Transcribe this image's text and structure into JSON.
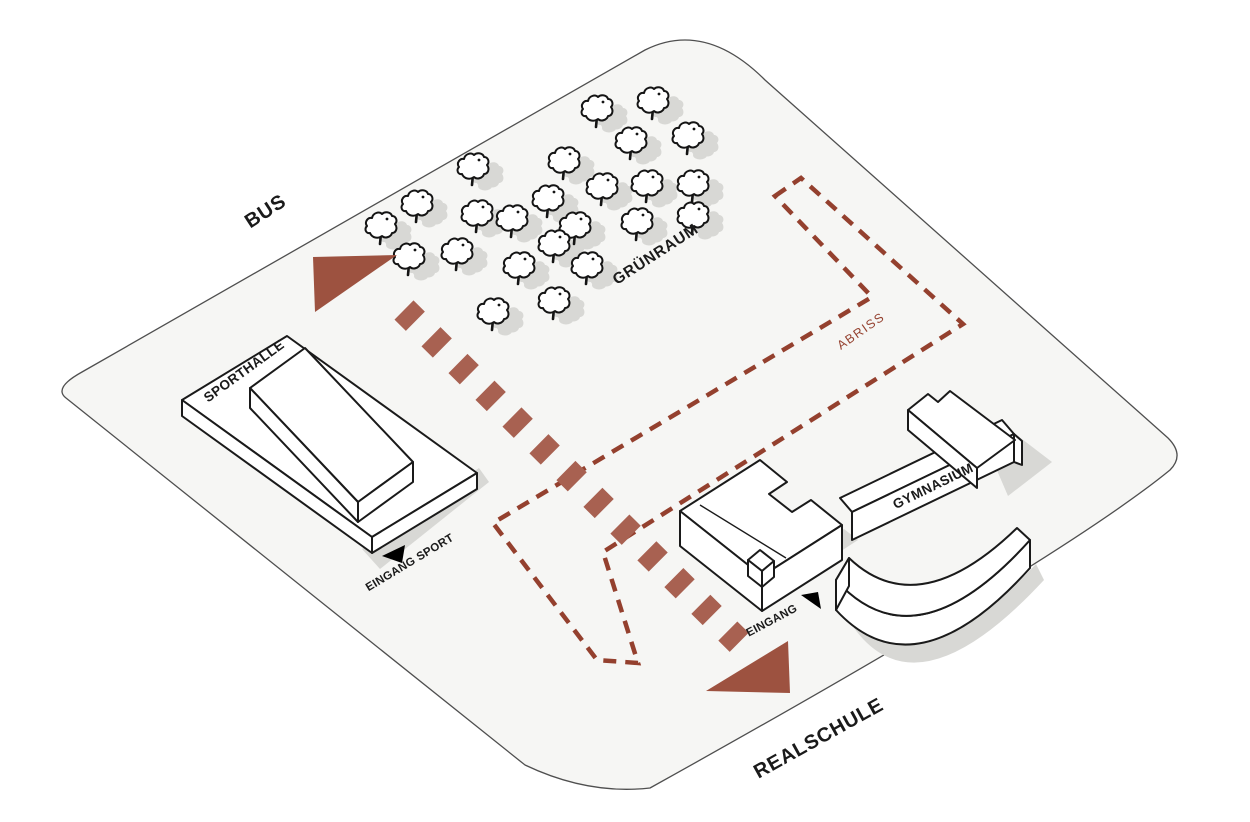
{
  "diagram_title": "Site circulation diagram",
  "labels": {
    "bus": "BUS",
    "gruenraum": "GRÜNRAUM",
    "abriss": "ABRISS",
    "sporthalle": "SPORTHALLE",
    "eingang_sport": "EINGANG SPORT",
    "eingang": "EINGANG",
    "gymnasium": "GYMNASIUM",
    "realschule": "REALSCHULE"
  },
  "colors": {
    "site_fill": "#f6f6f4",
    "site_stroke": "#4f4f4f",
    "demolition_dash": "#94402e",
    "arrow_band": "#a86151",
    "arrow_head": "#9d5240",
    "tree_stroke": "#141414",
    "shadow": "#d8d8d5",
    "building_fill": "#ffffff",
    "building_stroke": "#1a1a1a",
    "entrance_marker": "#000000",
    "label_color": "#1a1a1a"
  },
  "trees": [
    [
      597,
      110
    ],
    [
      653,
      102
    ],
    [
      688,
      137
    ],
    [
      631,
      142
    ],
    [
      564,
      162
    ],
    [
      473,
      168
    ],
    [
      417,
      205
    ],
    [
      381,
      227
    ],
    [
      602,
      188
    ],
    [
      647,
      185
    ],
    [
      693,
      185
    ],
    [
      548,
      200
    ],
    [
      512,
      220
    ],
    [
      477,
      215
    ],
    [
      575,
      227
    ],
    [
      637,
      223
    ],
    [
      693,
      217
    ],
    [
      409,
      258
    ],
    [
      457,
      253
    ],
    [
      554,
      245
    ],
    [
      519,
      267
    ],
    [
      587,
      267
    ],
    [
      493,
      313
    ],
    [
      554,
      302
    ]
  ],
  "circulation": {
    "from_label": "BUS",
    "to_label": "REALSCHULE",
    "style": "dashed-arrow-both-ends"
  },
  "demolition_area_label": "ABRISS",
  "entrances": [
    "EINGANG SPORT",
    "EINGANG"
  ]
}
